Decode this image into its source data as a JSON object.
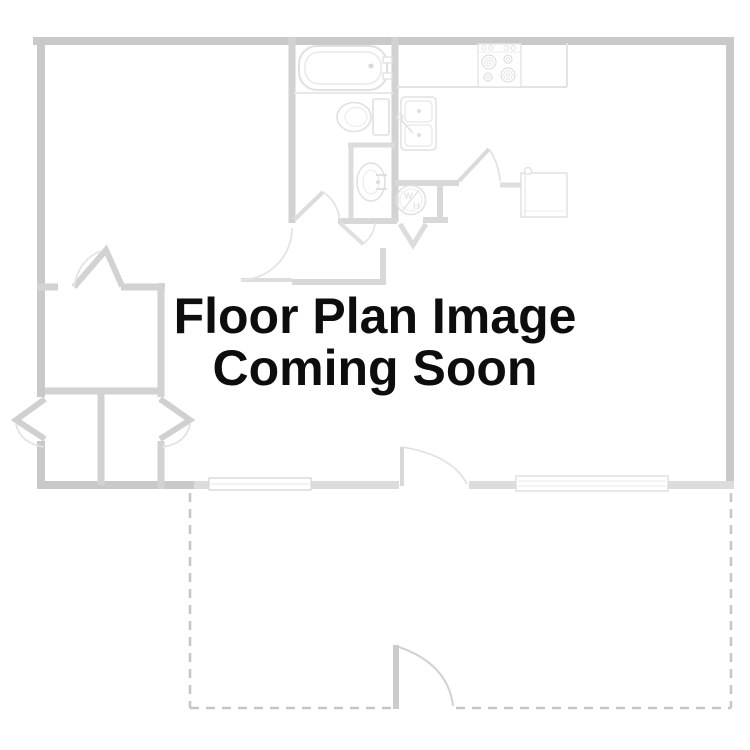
{
  "placeholder": {
    "line1": "Floor Plan Image",
    "line2": "Coming Soon",
    "text_color": "#0d0d0d"
  },
  "floor_plan": {
    "type": "apartment-floor-plan-line-drawing",
    "style": "faded light gray line art on white",
    "wall_color": "#c9c9c9",
    "interior_wall_color": "#d2d2d2",
    "fixture_line_color": "#e1e1e1",
    "patio_dash_color": "#c6c6c6",
    "background_color": "#ffffff",
    "washer_label_top": "W",
    "washer_label_bottom": "H",
    "fixtures": [
      "bathtub",
      "toilet",
      "pedestal sink",
      "double-basin kitchen sink",
      "stove with four burners",
      "refrigerator",
      "washer/heater closet circle",
      "window on bottom wall (left)",
      "window on bottom wall (right)",
      "dashed patio outline with gate door",
      "interior door swings"
    ]
  }
}
